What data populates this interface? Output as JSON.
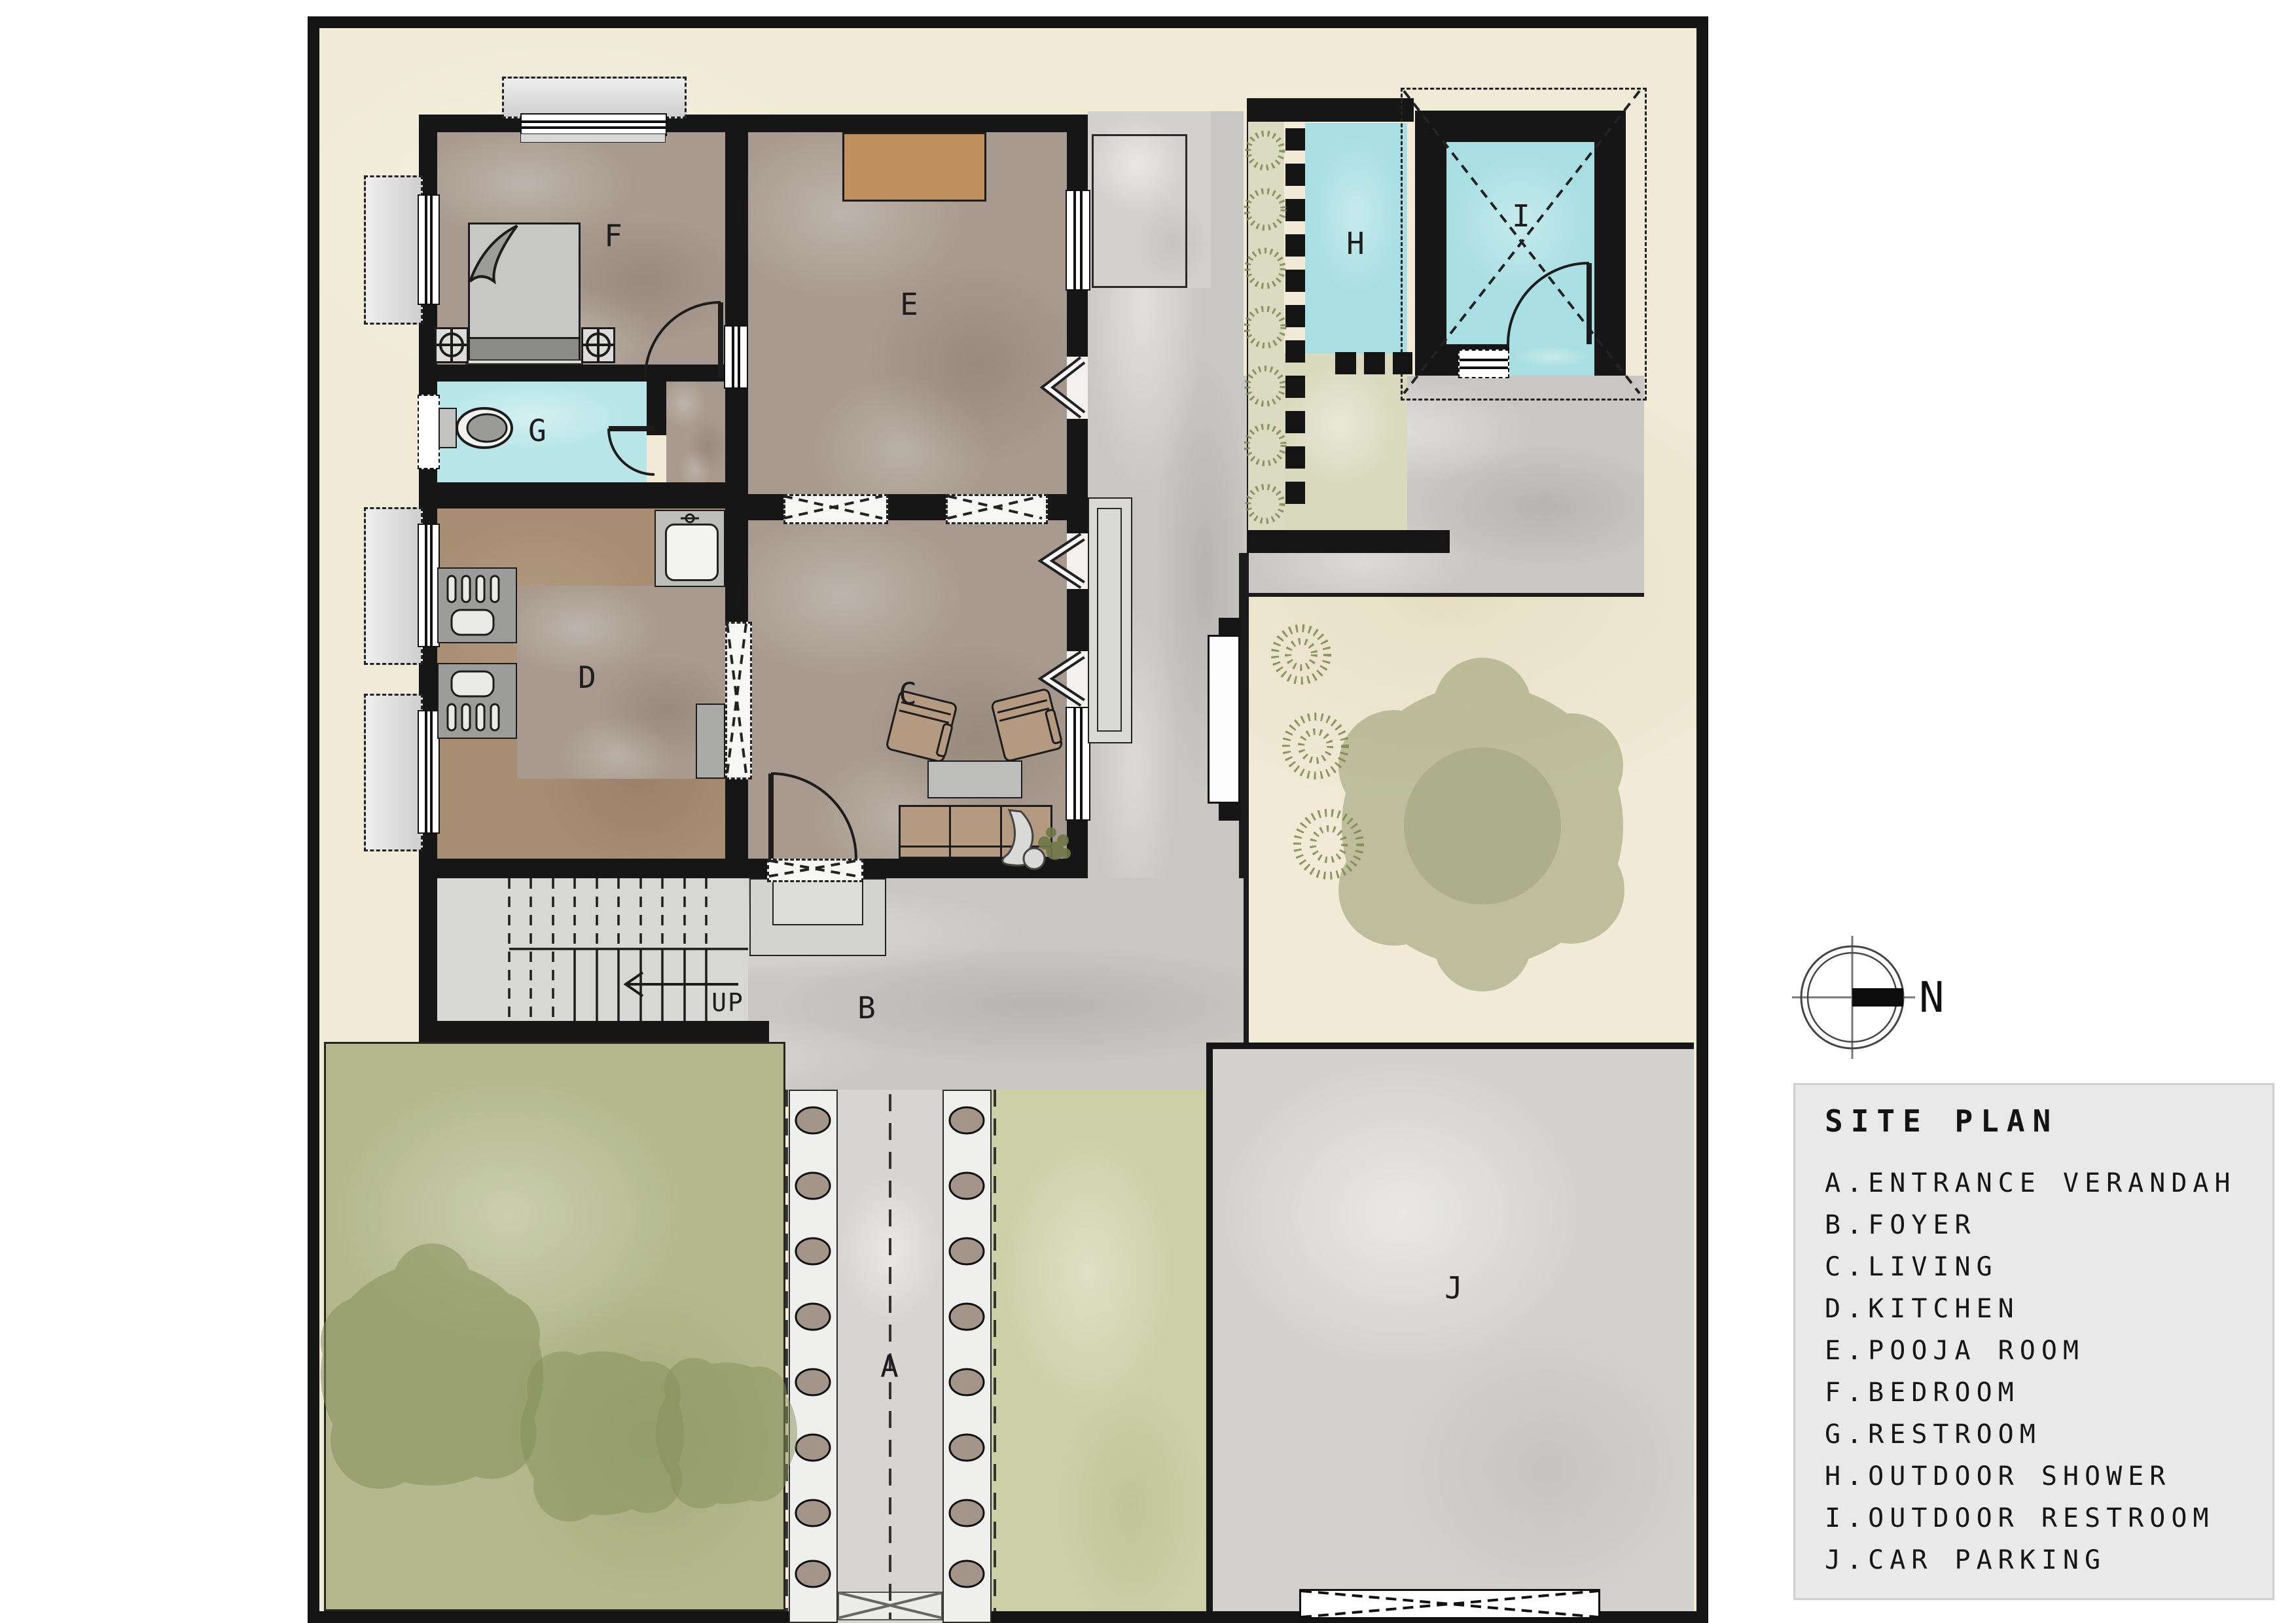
{
  "drawing": {
    "type": "architectural site plan",
    "compass": {
      "north_label": "N",
      "direction": "north points right"
    },
    "stairs": {
      "up_label": "UP",
      "arrow_direction": "left"
    }
  },
  "site_plan": {
    "rooms": [
      {
        "key": "A",
        "label": "A",
        "name": "Entrance Verandah"
      },
      {
        "key": "B",
        "label": "B",
        "name": "Foyer"
      },
      {
        "key": "C",
        "label": "C",
        "name": "Living"
      },
      {
        "key": "D",
        "label": "D",
        "name": "Kitchen"
      },
      {
        "key": "E",
        "label": "E",
        "name": "Pooja Room"
      },
      {
        "key": "F",
        "label": "F",
        "name": "Bedroom"
      },
      {
        "key": "G",
        "label": "G",
        "name": "Restroom"
      },
      {
        "key": "H",
        "label": "H",
        "name": "Outdoor Shower"
      },
      {
        "key": "I",
        "label": "I",
        "name": "Outdoor Restroom"
      },
      {
        "key": "J",
        "label": "J",
        "name": "Car Parking"
      }
    ]
  },
  "legend": {
    "title": "SITE PLAN",
    "items": [
      {
        "text": "A.ENTRANCE VERANDAH"
      },
      {
        "text": "B.FOYER"
      },
      {
        "text": "C.LIVING"
      },
      {
        "text": "D.KITCHEN"
      },
      {
        "text": "E.POOJA ROOM"
      },
      {
        "text": "F.BEDROOM"
      },
      {
        "text": "G.RESTROOM"
      },
      {
        "text": "H.OUTDOOR SHOWER"
      },
      {
        "text": "I.OUTDOOR RESTROOM"
      },
      {
        "text": "J.CAR PARKING"
      }
    ]
  },
  "colors": {
    "site_ground": "#f0ead6",
    "room_floor": "#a89a8e",
    "kitchen_counter": "#a78d72",
    "wet_area": "#b8e6e8",
    "concrete": "#c8c7c4",
    "lawn": "#b3b98c",
    "walls": "#161616",
    "legend_bg": "#e9e9e9"
  }
}
